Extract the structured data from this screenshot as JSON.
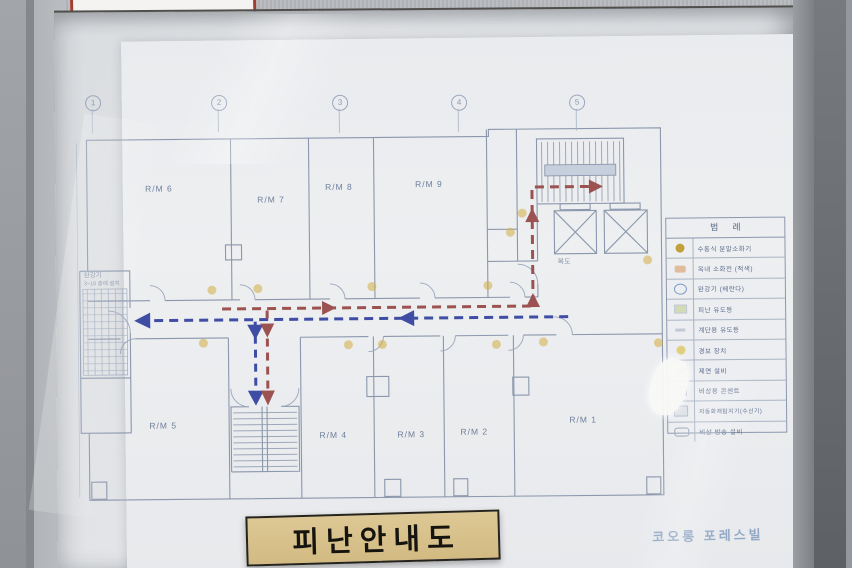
{
  "scene": {
    "title_plate": "피난안내도",
    "brand": "코오롱 포레스빌"
  },
  "plan": {
    "grid_markers": [
      "1",
      "2",
      "3",
      "4",
      "5"
    ],
    "rooms": [
      {
        "label": "R/M 6"
      },
      {
        "label": "R/M 7"
      },
      {
        "label": "R/M 8"
      },
      {
        "label": "R/M 9"
      },
      {
        "label": "R/M 5"
      },
      {
        "label": "R/M 4"
      },
      {
        "label": "R/M 3"
      },
      {
        "label": "R/M 2"
      },
      {
        "label": "R/M 1"
      }
    ],
    "labels": {
      "corridor": "복도",
      "descender": "완강기",
      "descender_note": "3~10 층에 설치"
    },
    "legend": {
      "title": "범례",
      "items": [
        {
          "icon": "extinguisher-icon",
          "label": "수동식 분말소화기"
        },
        {
          "icon": "hydrant-icon",
          "label": "옥내 소화전 (적색)"
        },
        {
          "icon": "descender-icon",
          "label": "완강기 (베란다)"
        },
        {
          "icon": "exit-light-icon",
          "label": "피난 유도등"
        },
        {
          "icon": "stair-light-icon",
          "label": "계단용 유도등"
        },
        {
          "icon": "alarm-icon",
          "label": "경보 장치"
        },
        {
          "icon": "smoke-control-icon",
          "label": "제연 설비"
        },
        {
          "icon": "outlet-icon",
          "label": "비상용 콘센트"
        },
        {
          "icon": "detector-icon",
          "label": "자동화재탐지기(수신기)"
        },
        {
          "icon": "broadcast-icon",
          "label": "비상 방송 설비"
        }
      ]
    },
    "route_colors": {
      "primary_blue": "#3f4da5",
      "secondary_red": "#9c5250"
    },
    "marker_dot_color": "#d4af45",
    "line_color": "#8b97ac"
  }
}
